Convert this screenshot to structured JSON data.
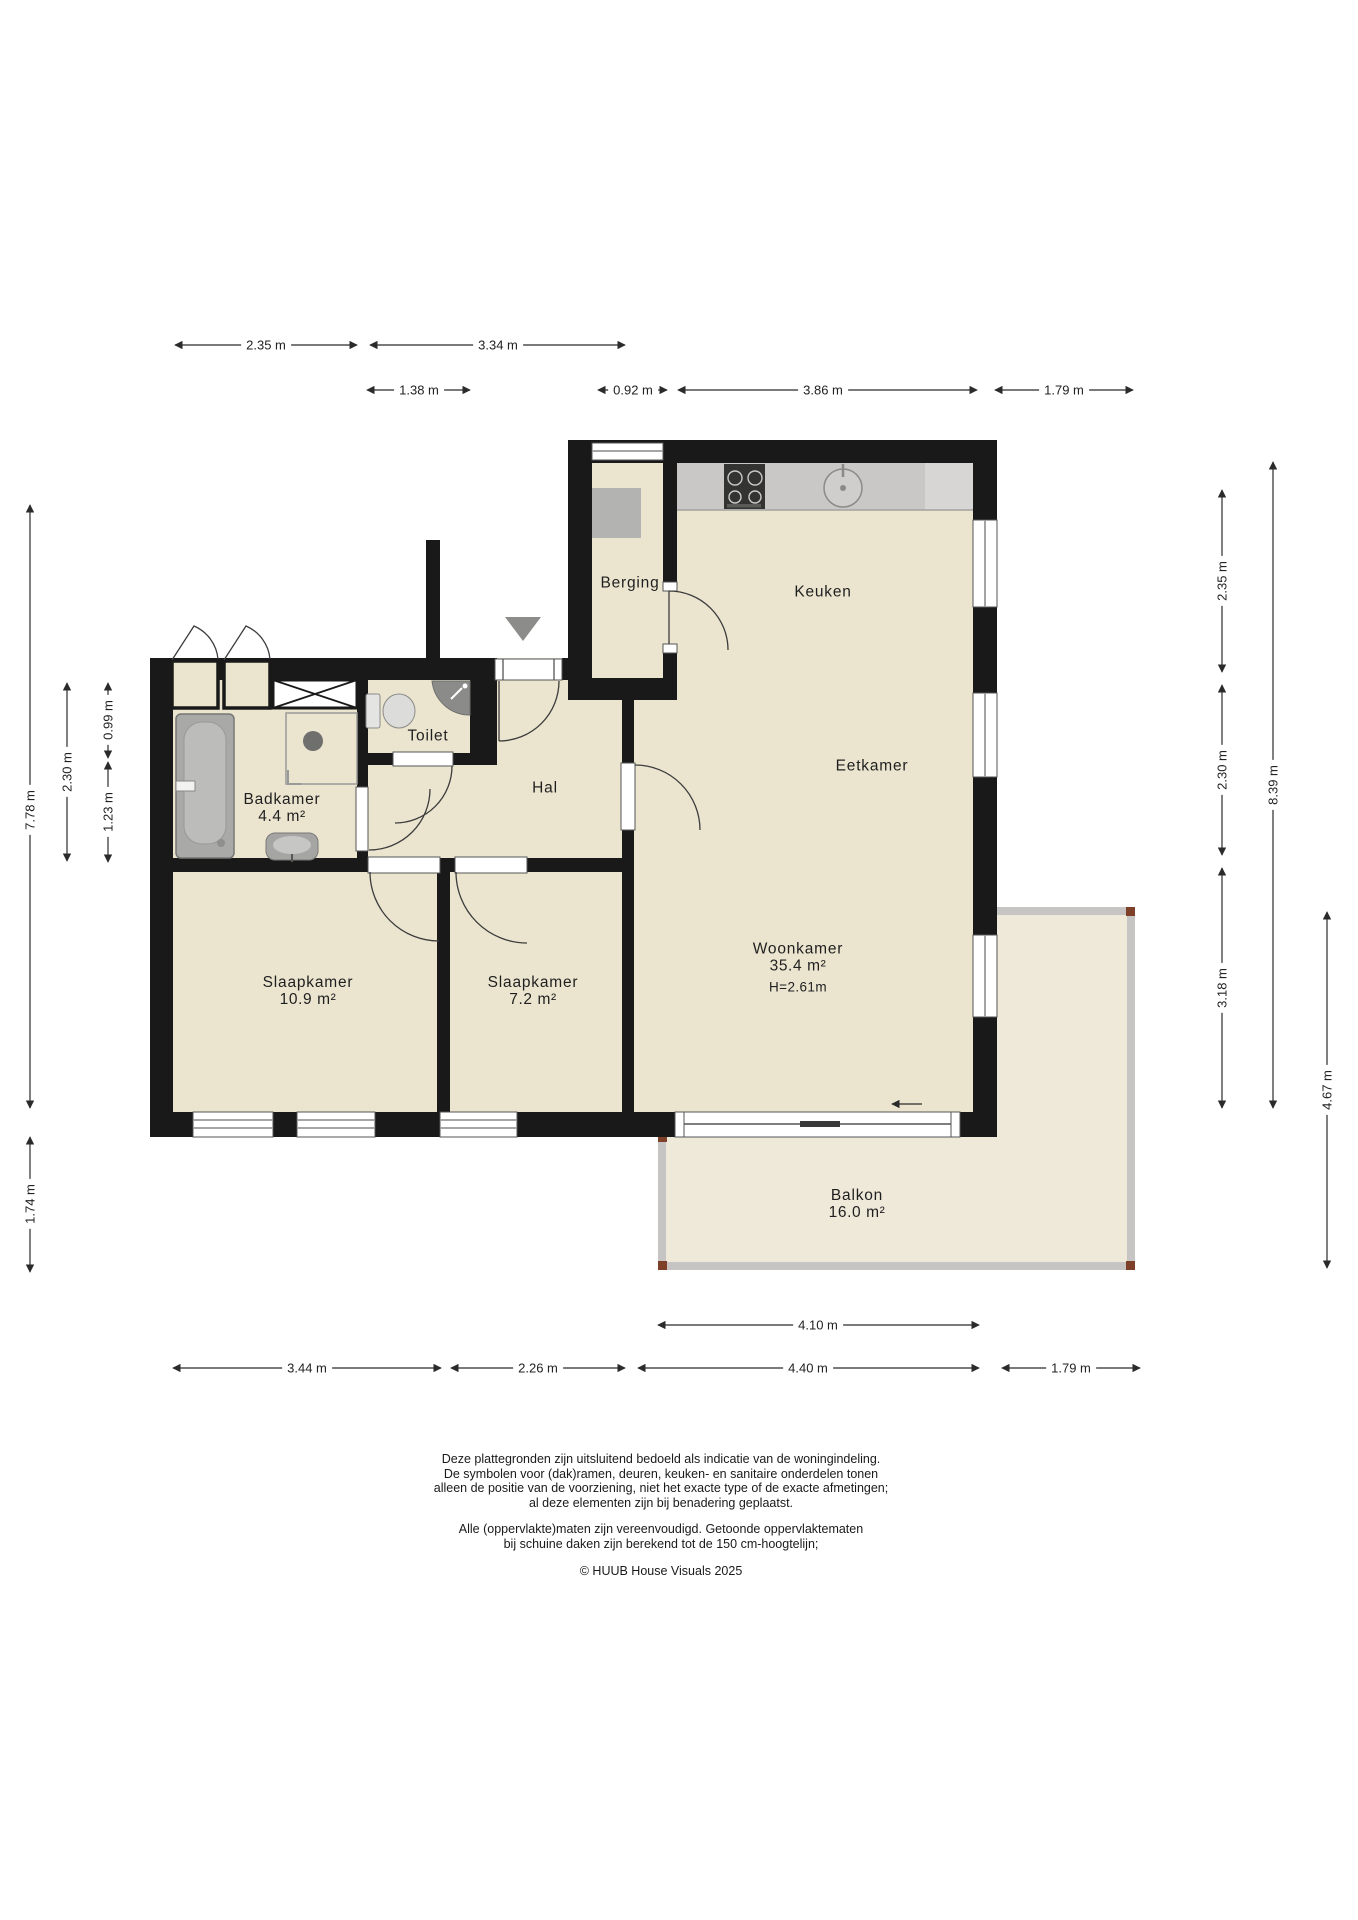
{
  "colors": {
    "wall": "#191919",
    "room_fill": "#ebe5d0",
    "balkon_fill": "#efe9da",
    "balkon_border": "#c6c5c3",
    "balkon_corner": "#7e4028",
    "counter": "#c9c8c6",
    "counter_light": "#d7d6d4",
    "dim_line": "#2b2b2b"
  },
  "rooms": {
    "berging": {
      "name": "Berging"
    },
    "keuken": {
      "name": "Keuken"
    },
    "eetkamer": {
      "name": "Eetkamer"
    },
    "toilet": {
      "name": "Toilet"
    },
    "hal": {
      "name": "Hal"
    },
    "badkamer": {
      "name": "Badkamer",
      "area": "4.4 m²"
    },
    "slaapkamer1": {
      "name": "Slaapkamer",
      "area": "10.9 m²"
    },
    "slaapkamer2": {
      "name": "Slaapkamer",
      "area": "7.2 m²"
    },
    "woonkamer": {
      "name": "Woonkamer",
      "area": "35.4 m²",
      "ceiling_height": "H=2.61m"
    },
    "balkon": {
      "name": "Balkon",
      "area": "16.0 m²"
    }
  },
  "dimensions": {
    "top": {
      "d1": "2.35 m",
      "d2": "3.34 m",
      "d3": "1.38 m",
      "d4": "0.92 m",
      "d5": "3.86 m",
      "d6": "1.79 m"
    },
    "left": {
      "d1": "7.78 m",
      "d2": "2.30 m",
      "d3": "0.99 m",
      "d4": "1.23 m",
      "d5": "1.74 m"
    },
    "right": {
      "d1": "2.35 m",
      "d2": "2.30 m",
      "d3": "3.18 m",
      "d4": "8.39 m",
      "d5": "4.67 m"
    },
    "bottom": {
      "d1": "3.44 m",
      "d2": "2.26 m",
      "d3": "4.40 m",
      "d4": "1.79 m",
      "d5": "4.10 m"
    }
  },
  "footer": {
    "disclaimer1": [
      "Deze plattegronden zijn uitsluitend bedoeld als indicatie van de woningindeling.",
      "De symbolen voor (dak)ramen, deuren, keuken- en sanitaire onderdelen tonen",
      "alleen de positie van de voorziening, niet het exacte type of de exacte afmetingen;",
      "al deze elementen zijn bij benadering geplaatst."
    ],
    "disclaimer2": [
      "Alle (oppervlakte)maten zijn vereenvoudigd. Getoonde oppervlaktematen",
      "bij schuine daken zijn berekend tot de 150 cm-hoogtelijn;"
    ],
    "copyright": "© HUUB House Visuals 2025"
  }
}
